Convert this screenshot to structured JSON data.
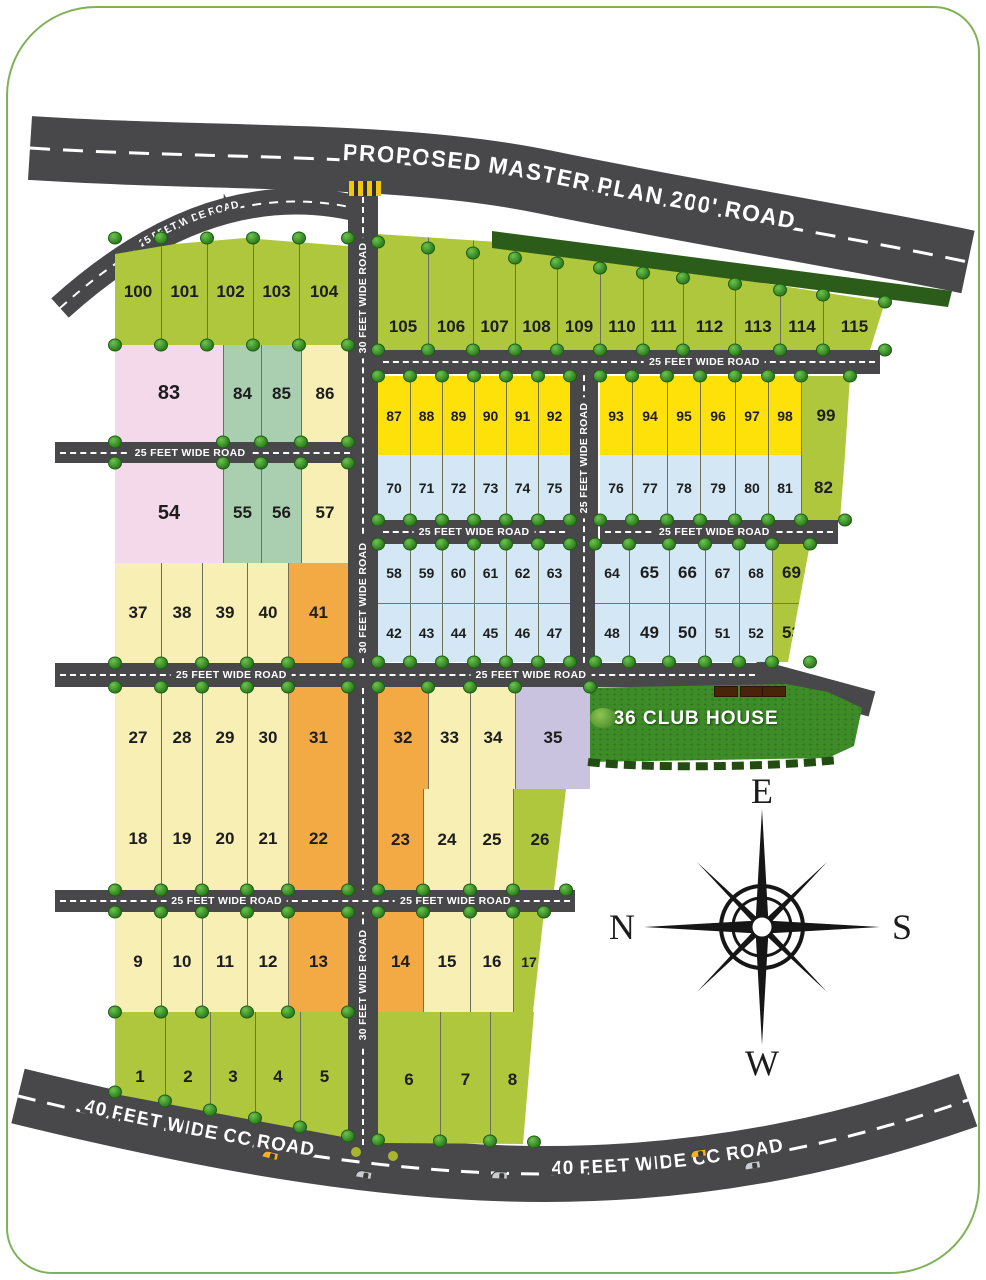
{
  "canvas": {
    "w": 986,
    "h": 1280,
    "bg": "#ffffff",
    "border_color": "#7fb257"
  },
  "labels": {
    "master_road": "PROPOSED MASTER PLAN 200' ROAD",
    "cc_road": "40 FEET WIDE CC ROAD",
    "road25": "25 FEET WIDE ROAD",
    "road30": "30 FEET WIDE ROAD",
    "club_house": "36 CLUB HOUSE"
  },
  "compass": {
    "top": "E",
    "left": "N",
    "right": "S",
    "bottom": "W",
    "cx": 762,
    "cy": 927
  },
  "colors": {
    "green": "#aec73d",
    "pink": "#f3d9e9",
    "teal": "#a9cfb0",
    "cream": "#f8efb4",
    "orange": "#f3aa45",
    "yellow": "#ffe10a",
    "blue": "#d3e8f4",
    "lavender": "#c9c3e0",
    "road": "#48484a",
    "hedge": "#2b5c19",
    "grass": "#3e8c28",
    "car_yellow": "#f2b124",
    "car_silver": "#c9cdd1"
  },
  "blocks": [
    {
      "name": "plots-100-104",
      "x": 115,
      "y": 238,
      "w": 233,
      "h": 107,
      "clip": [
        [
          0,
          16
        ],
        [
          60,
          6
        ],
        [
          130,
          0
        ],
        [
          233,
          8
        ],
        [
          233,
          107
        ],
        [
          0,
          107
        ]
      ],
      "bushTop": true,
      "bushBottom": true,
      "rows": [
        [
          [
            "100",
            "green",
            46
          ],
          [
            "101",
            "green",
            46
          ],
          [
            "102",
            "green",
            46
          ],
          [
            "103",
            "green",
            46
          ],
          [
            "104",
            "green",
            49
          ]
        ]
      ]
    },
    {
      "name": "plots-83-86",
      "x": 115,
      "y": 345,
      "w": 233,
      "h": 97,
      "bushBottom": true,
      "rows": [
        [
          [
            "83",
            "pink",
            108
          ],
          [
            "84",
            "teal",
            38
          ],
          [
            "85",
            "teal",
            40
          ],
          [
            "86",
            "cream",
            47
          ]
        ]
      ]
    },
    {
      "name": "plots-54-57",
      "x": 115,
      "y": 463,
      "w": 233,
      "h": 100,
      "bushTop": true,
      "rows": [
        [
          [
            "54",
            "pink",
            108
          ],
          [
            "55",
            "teal",
            38
          ],
          [
            "56",
            "teal",
            40
          ],
          [
            "57",
            "cream",
            47
          ]
        ]
      ]
    },
    {
      "name": "plots-37-41",
      "x": 115,
      "y": 563,
      "w": 233,
      "h": 100,
      "bushBottom": true,
      "rows": [
        [
          [
            "37",
            "cream",
            46
          ],
          [
            "38",
            "cream",
            41
          ],
          [
            "39",
            "cream",
            45
          ],
          [
            "40",
            "cream",
            41
          ],
          [
            "41",
            "orange",
            60
          ]
        ]
      ]
    },
    {
      "name": "plots-27-31",
      "x": 115,
      "y": 687,
      "w": 233,
      "h": 101,
      "bushTop": true,
      "rows": [
        [
          [
            "27",
            "cream",
            46
          ],
          [
            "28",
            "cream",
            41
          ],
          [
            "29",
            "cream",
            45
          ],
          [
            "30",
            "cream",
            41
          ],
          [
            "31",
            "orange",
            60
          ]
        ]
      ]
    },
    {
      "name": "plots-18-22",
      "x": 115,
      "y": 788,
      "w": 233,
      "h": 102,
      "bushBottom": true,
      "rows": [
        [
          [
            "18",
            "cream",
            46
          ],
          [
            "19",
            "cream",
            41
          ],
          [
            "20",
            "cream",
            45
          ],
          [
            "21",
            "cream",
            41
          ],
          [
            "22",
            "orange",
            60
          ]
        ]
      ]
    },
    {
      "name": "plots-9-13",
      "x": 115,
      "y": 912,
      "w": 233,
      "h": 100,
      "bushTop": true,
      "bushBottom": true,
      "rows": [
        [
          [
            "9",
            "cream",
            46
          ],
          [
            "10",
            "cream",
            41
          ],
          [
            "11",
            "cream",
            45
          ],
          [
            "12",
            "cream",
            41
          ],
          [
            "13",
            "orange",
            60
          ]
        ]
      ]
    },
    {
      "name": "plots-1-5",
      "x": 115,
      "y": 1012,
      "w": 233,
      "h": 130,
      "clip": [
        [
          0,
          0
        ],
        [
          233,
          0
        ],
        [
          233,
          126
        ],
        [
          0,
          82
        ]
      ],
      "bushBottomLine": [
        1092,
        1136
      ],
      "rows": [
        [
          [
            "1",
            "green",
            50
          ],
          [
            "2",
            "green",
            45
          ],
          [
            "3",
            "green",
            45
          ],
          [
            "4",
            "green",
            45
          ],
          [
            "5",
            "green",
            48
          ]
        ]
      ]
    },
    {
      "name": "plots-105-115",
      "x": 378,
      "y": 230,
      "w": 507,
      "h": 120,
      "clip": [
        [
          0,
          4
        ],
        [
          120,
          12
        ],
        [
          507,
          72
        ],
        [
          492,
          120
        ],
        [
          0,
          120
        ]
      ],
      "numEnd": true,
      "bushBottom": true,
      "bushTopLine": [
        242,
        302
      ],
      "rows": [
        [
          [
            "105",
            "green",
            50
          ],
          [
            "106",
            "green",
            45
          ],
          [
            "107",
            "green",
            42
          ],
          [
            "108",
            "green",
            42
          ],
          [
            "109",
            "green",
            43
          ],
          [
            "110",
            "green",
            43
          ],
          [
            "111",
            "green",
            40
          ],
          [
            "112",
            "green",
            52
          ],
          [
            "113",
            "green",
            45
          ],
          [
            "114",
            "green",
            43
          ],
          [
            "115",
            "green",
            62
          ]
        ]
      ]
    },
    {
      "name": "plots-87-92",
      "x": 378,
      "y": 376,
      "w": 192,
      "h": 79,
      "bushTop": true,
      "rows": [
        [
          [
            "87",
            "yellow",
            32
          ],
          [
            "88",
            "yellow",
            32
          ],
          [
            "89",
            "yellow",
            32
          ],
          [
            "90",
            "yellow",
            32
          ],
          [
            "91",
            "yellow",
            32
          ],
          [
            "92",
            "yellow",
            32
          ]
        ]
      ]
    },
    {
      "name": "plots-70-75",
      "x": 378,
      "y": 455,
      "w": 192,
      "h": 65,
      "bushBottom": true,
      "rows": [
        [
          [
            "70",
            "blue",
            32
          ],
          [
            "71",
            "blue",
            32
          ],
          [
            "72",
            "blue",
            32
          ],
          [
            "73",
            "blue",
            32
          ],
          [
            "74",
            "blue",
            32
          ],
          [
            "75",
            "blue",
            32
          ]
        ]
      ]
    },
    {
      "name": "plots-58-63-42-47",
      "x": 378,
      "y": 544,
      "w": 192,
      "h": 118,
      "bushTop": true,
      "bushBottom": true,
      "rows": [
        [
          [
            "58",
            "blue",
            32
          ],
          [
            "59",
            "blue",
            32
          ],
          [
            "60",
            "blue",
            32
          ],
          [
            "61",
            "blue",
            32
          ],
          [
            "62",
            "blue",
            32
          ],
          [
            "63",
            "blue",
            32
          ]
        ],
        [
          [
            "42",
            "blue",
            32
          ],
          [
            "43",
            "blue",
            32
          ],
          [
            "44",
            "blue",
            32
          ],
          [
            "45",
            "blue",
            32
          ],
          [
            "46",
            "blue",
            32
          ],
          [
            "47",
            "blue",
            32
          ]
        ]
      ]
    },
    {
      "name": "plots-32-35",
      "x": 378,
      "y": 687,
      "w": 212,
      "h": 102,
      "bushTop": true,
      "rows": [
        [
          [
            "32",
            "orange",
            50
          ],
          [
            "33",
            "cream",
            42
          ],
          [
            "34",
            "cream",
            45
          ],
          [
            "35",
            "lavender",
            75
          ]
        ]
      ]
    },
    {
      "name": "plots-23-26",
      "x": 378,
      "y": 789,
      "w": 188,
      "h": 101,
      "clip": [
        [
          0,
          0
        ],
        [
          188,
          0
        ],
        [
          176,
          101
        ],
        [
          0,
          101
        ]
      ],
      "bushBottom": true,
      "rows": [
        [
          [
            "23",
            "orange",
            45
          ],
          [
            "24",
            "cream",
            47
          ],
          [
            "25",
            "cream",
            43
          ],
          [
            "26",
            "green",
            53
          ]
        ]
      ]
    },
    {
      "name": "plots-14-17",
      "x": 378,
      "y": 912,
      "w": 166,
      "h": 100,
      "clip": [
        [
          0,
          0
        ],
        [
          166,
          0
        ],
        [
          155,
          100
        ],
        [
          0,
          100
        ]
      ],
      "bushTop": true,
      "rows": [
        [
          [
            "14",
            "orange",
            45
          ],
          [
            "15",
            "cream",
            47
          ],
          [
            "16",
            "cream",
            43
          ],
          [
            "17",
            "green",
            31
          ]
        ]
      ]
    },
    {
      "name": "plots-6-8",
      "x": 378,
      "y": 1012,
      "w": 156,
      "h": 135,
      "clip": [
        [
          0,
          0
        ],
        [
          156,
          0
        ],
        [
          145,
          132
        ],
        [
          0,
          131
        ]
      ],
      "bushBottomLine": [
        1140,
        1142
      ],
      "rows": [
        [
          [
            "6",
            "green",
            62
          ],
          [
            "7",
            "green",
            50
          ],
          [
            "8",
            "green",
            44
          ]
        ]
      ]
    },
    {
      "name": "plots-93-99",
      "x": 600,
      "y": 376,
      "w": 250,
      "h": 79,
      "clip": [
        [
          0,
          0
        ],
        [
          250,
          0
        ],
        [
          245,
          79
        ],
        [
          0,
          79
        ]
      ],
      "bushTop": true,
      "rows": [
        [
          [
            "93",
            "yellow",
            32
          ],
          [
            "94",
            "yellow",
            35
          ],
          [
            "95",
            "yellow",
            33
          ],
          [
            "96",
            "yellow",
            35
          ],
          [
            "97",
            "yellow",
            33
          ],
          [
            "98",
            "yellow",
            33
          ],
          [
            "99",
            "green",
            49
          ]
        ]
      ]
    },
    {
      "name": "plots-76-82",
      "x": 600,
      "y": 455,
      "w": 245,
      "h": 65,
      "clip": [
        [
          0,
          0
        ],
        [
          245,
          0
        ],
        [
          240,
          65
        ],
        [
          0,
          65
        ]
      ],
      "bushBottom": true,
      "rows": [
        [
          [
            "76",
            "blue",
            32
          ],
          [
            "77",
            "blue",
            35
          ],
          [
            "78",
            "blue",
            33
          ],
          [
            "79",
            "blue",
            35
          ],
          [
            "80",
            "blue",
            33
          ],
          [
            "81",
            "blue",
            33
          ],
          [
            "82",
            "green",
            44
          ]
        ]
      ]
    },
    {
      "name": "plots-64-69-48-53",
      "x": 595,
      "y": 544,
      "w": 215,
      "h": 118,
      "clip": [
        [
          0,
          0
        ],
        [
          215,
          0
        ],
        [
          193,
          118
        ],
        [
          0,
          118
        ]
      ],
      "bushTop": true,
      "bushBottom": true,
      "rows": [
        [
          [
            "64",
            "blue",
            34
          ],
          [
            "65",
            "blue",
            40
          ],
          [
            "66",
            "blue",
            36
          ],
          [
            "67",
            "blue",
            34
          ],
          [
            "68",
            "blue",
            33
          ],
          [
            "69",
            "green",
            38
          ]
        ],
        [
          [
            "48",
            "blue",
            34
          ],
          [
            "49",
            "blue",
            40
          ],
          [
            "50",
            "blue",
            36
          ],
          [
            "51",
            "blue",
            34
          ],
          [
            "52",
            "blue",
            33
          ],
          [
            "53",
            "green",
            38
          ]
        ]
      ]
    }
  ],
  "roads_h": [
    {
      "x": 55,
      "y": 442,
      "w": 300,
      "h": 21,
      "labels": [
        [
          0.45,
          "road25"
        ]
      ]
    },
    {
      "x": 55,
      "y": 663,
      "w": 705,
      "h": 24,
      "labels": [
        [
          0.25,
          "road25"
        ],
        [
          0.675,
          "road25"
        ]
      ]
    },
    {
      "x": 55,
      "y": 890,
      "w": 520,
      "h": 22,
      "labels": [
        [
          0.33,
          "road25"
        ],
        [
          0.77,
          "road25"
        ]
      ]
    },
    {
      "x": 378,
      "y": 350,
      "w": 502,
      "h": 24,
      "labels": [
        [
          0.65,
          "road25"
        ]
      ]
    },
    {
      "x": 378,
      "y": 520,
      "w": 192,
      "h": 24,
      "labels": [
        [
          0.5,
          "road25"
        ]
      ]
    },
    {
      "x": 600,
      "y": 520,
      "w": 238,
      "h": 24,
      "labels": [
        [
          0.48,
          "road25"
        ]
      ]
    }
  ],
  "roads_v": [
    {
      "x": 348,
      "y": 182,
      "w": 30,
      "h": 968,
      "labels": [
        [
          0.12,
          "road30"
        ],
        [
          0.43,
          "road30"
        ],
        [
          0.83,
          "road30"
        ]
      ]
    },
    {
      "x": 570,
      "y": 350,
      "w": 28,
      "h": 338,
      "labels": [
        [
          0.32,
          "road25"
        ]
      ]
    }
  ],
  "trees": [
    [
      46,
      130
    ],
    [
      240,
      150
    ],
    [
      447,
      178
    ],
    [
      652,
      212
    ],
    [
      905,
      238
    ],
    [
      935,
      348
    ],
    [
      100,
      250
    ],
    [
      106,
      435
    ],
    [
      100,
      550
    ],
    [
      102,
      735
    ],
    [
      60,
      990
    ],
    [
      47,
      1095
    ],
    [
      80,
      1180
    ],
    [
      284,
      1225
    ],
    [
      447,
      1240
    ],
    [
      532,
      1160
    ],
    [
      598,
      1250
    ],
    [
      662,
      1145
    ],
    [
      814,
      1192
    ],
    [
      857,
      1105
    ],
    [
      880,
      1225
    ],
    [
      558,
      980
    ],
    [
      844,
      768
    ]
  ],
  "cars": [
    {
      "x": 262,
      "y": 1148,
      "rot": 14,
      "c": "car_yellow"
    },
    {
      "x": 355,
      "y": 1168,
      "rot": 10,
      "c": "car_silver"
    },
    {
      "x": 490,
      "y": 1170,
      "rot": 2,
      "c": "car_silver"
    },
    {
      "x": 688,
      "y": 1150,
      "rot": -8,
      "c": "car_yellow"
    },
    {
      "x": 742,
      "y": 1162,
      "rot": -9,
      "c": "car_silver"
    }
  ],
  "club": {
    "x": 576,
    "y": 682,
    "w": 286,
    "h": 84,
    "clip": [
      [
        2,
        6
      ],
      [
        210,
        2
      ],
      [
        252,
        10
      ],
      [
        286,
        26
      ],
      [
        278,
        64
      ],
      [
        252,
        76
      ],
      [
        10,
        80
      ]
    ],
    "parked": [
      [
        138,
        4
      ],
      [
        164,
        4
      ],
      [
        186,
        4
      ]
    ]
  }
}
